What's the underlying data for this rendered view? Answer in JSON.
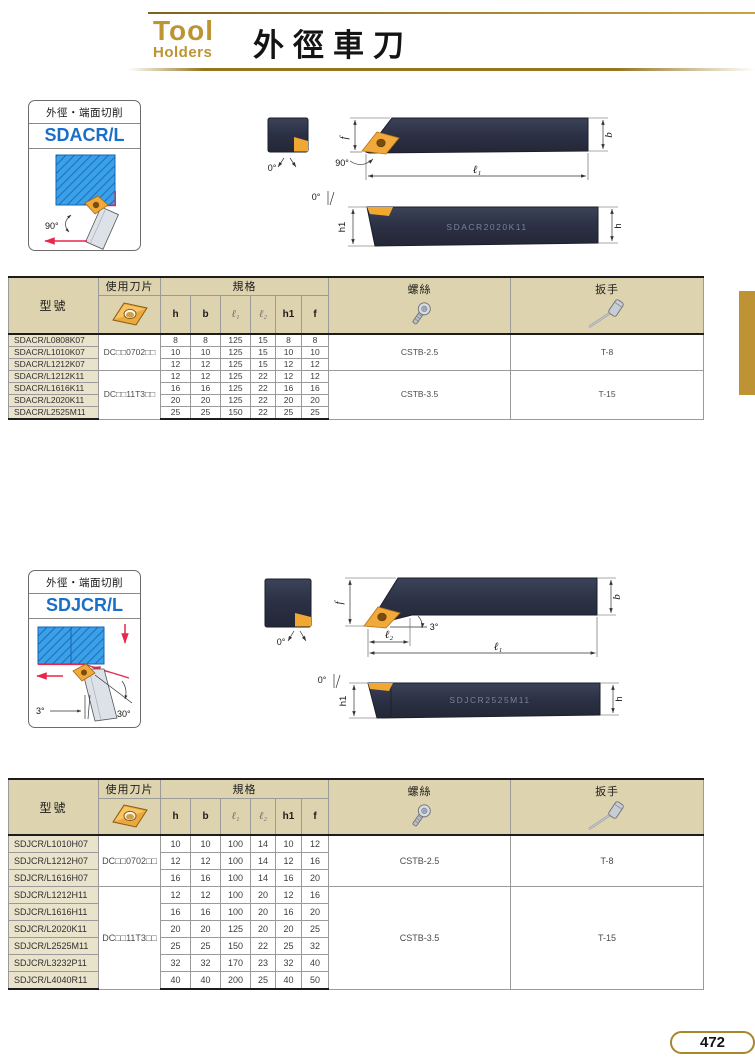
{
  "header": {
    "brand_line1": "Tool",
    "brand_line2": "Holders",
    "title": "外徑車刀"
  },
  "page_number": "472",
  "colors": {
    "accent-gold": "#bd9334",
    "name-blue": "#1a6fc9",
    "table-header-tan": "#ddd3ae",
    "model-cell-beige": "#eae3cb",
    "insert-gold": "#f0a832",
    "tool-body-dark": "#2e3347",
    "workpiece-blue": "#3aa0e8",
    "arrow-red": "#e8274b"
  },
  "icons": {
    "insert": "diamond-insert-icon",
    "screw": "torx-screw-icon",
    "wrench": "torx-key-icon"
  },
  "sections": [
    {
      "box": {
        "subtitle": "外徑・端面切削",
        "name": "SDACR/L",
        "angle_main": "90°"
      },
      "drawing": {
        "end_angle": "0°",
        "front_angle": "90°",
        "top_angle": "0°",
        "dim_f": "f",
        "dim_b": "b",
        "dim_l1": "ℓ₁",
        "dim_h1": "h1",
        "dim_h": "h",
        "marking": "SDACR2020K11"
      },
      "table": {
        "headers": {
          "model": "型號",
          "insert": "使用刀片",
          "spec": "規格",
          "screw": "螺絲",
          "wrench": "扳手",
          "spec_cols": [
            "h",
            "b",
            "ℓ₁",
            "ℓ₂",
            "h1",
            "f"
          ]
        },
        "groups": [
          {
            "insert": "DC□□0702□□",
            "screw": "CSTB-2.5",
            "wrench": "T-8",
            "rows": [
              {
                "model": "SDACR/L0808K07",
                "values": [
                  "8",
                  "8",
                  "125",
                  "15",
                  "8",
                  "8"
                ]
              },
              {
                "model": "SDACR/L1010K07",
                "values": [
                  "10",
                  "10",
                  "125",
                  "15",
                  "10",
                  "10"
                ]
              },
              {
                "model": "SDACR/L1212K07",
                "values": [
                  "12",
                  "12",
                  "125",
                  "15",
                  "12",
                  "12"
                ]
              }
            ]
          },
          {
            "insert": "DC□□11T3□□",
            "screw": "CSTB-3.5",
            "wrench": "T-15",
            "rows": [
              {
                "model": "SDACR/L1212K11",
                "values": [
                  "12",
                  "12",
                  "125",
                  "22",
                  "12",
                  "12"
                ]
              },
              {
                "model": "SDACR/L1616K11",
                "values": [
                  "16",
                  "16",
                  "125",
                  "22",
                  "16",
                  "16"
                ]
              },
              {
                "model": "SDACR/L2020K11",
                "values": [
                  "20",
                  "20",
                  "125",
                  "22",
                  "20",
                  "20"
                ]
              },
              {
                "model": "SDACR/L2525M11",
                "values": [
                  "25",
                  "25",
                  "150",
                  "22",
                  "25",
                  "25"
                ]
              }
            ]
          }
        ]
      }
    },
    {
      "box": {
        "subtitle": "外徑・端面切削",
        "name": "SDJCR/L",
        "angle_lead": "3°",
        "angle_relief": "30°"
      },
      "drawing": {
        "end_angle": "0°",
        "side_angle": "3°",
        "top_angle": "0°",
        "dim_f": "f",
        "dim_b": "b",
        "dim_l1": "ℓ₁",
        "dim_l2": "ℓ₂",
        "dim_h1": "h1",
        "dim_h": "h",
        "marking": "SDJCR2525M11"
      },
      "table": {
        "headers": {
          "model": "型號",
          "insert": "使用刀片",
          "spec": "規格",
          "screw": "螺絲",
          "wrench": "扳手",
          "spec_cols": [
            "h",
            "b",
            "ℓ₁",
            "ℓ₂",
            "h1",
            "f"
          ]
        },
        "groups": [
          {
            "insert": "DC□□0702□□",
            "screw": "CSTB-2.5",
            "wrench": "T-8",
            "rows": [
              {
                "model": "SDJCR/L1010H07",
                "values": [
                  "10",
                  "10",
                  "100",
                  "14",
                  "10",
                  "12"
                ]
              },
              {
                "model": "SDJCR/L1212H07",
                "values": [
                  "12",
                  "12",
                  "100",
                  "14",
                  "12",
                  "16"
                ]
              },
              {
                "model": "SDJCR/L1616H07",
                "values": [
                  "16",
                  "16",
                  "100",
                  "14",
                  "16",
                  "20"
                ]
              }
            ]
          },
          {
            "insert": "DC□□11T3□□",
            "screw": "CSTB-3.5",
            "wrench": "T-15",
            "rows": [
              {
                "model": "SDJCR/L1212H11",
                "values": [
                  "12",
                  "12",
                  "100",
                  "20",
                  "12",
                  "16"
                ]
              },
              {
                "model": "SDJCR/L1616H11",
                "values": [
                  "16",
                  "16",
                  "100",
                  "20",
                  "16",
                  "20"
                ]
              },
              {
                "model": "SDJCR/L2020K11",
                "values": [
                  "20",
                  "20",
                  "125",
                  "20",
                  "20",
                  "25"
                ]
              },
              {
                "model": "SDJCR/L2525M11",
                "values": [
                  "25",
                  "25",
                  "150",
                  "22",
                  "25",
                  "32"
                ]
              },
              {
                "model": "SDJCR/L3232P11",
                "values": [
                  "32",
                  "32",
                  "170",
                  "23",
                  "32",
                  "40"
                ]
              },
              {
                "model": "SDJCR/L4040R11",
                "values": [
                  "40",
                  "40",
                  "200",
                  "25",
                  "40",
                  "50"
                ]
              }
            ]
          }
        ]
      }
    }
  ]
}
